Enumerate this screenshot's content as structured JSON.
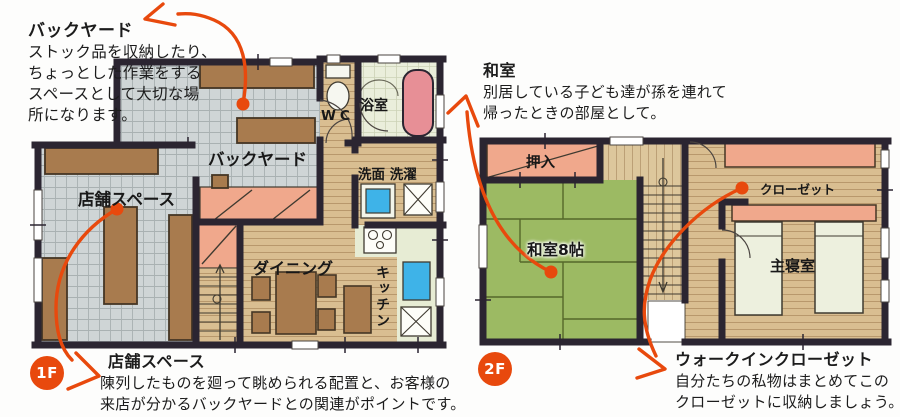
{
  "colors": {
    "accent": "#e8490d",
    "wall": "#2b2531",
    "floor_grid": "#cfd5d6",
    "wood": "#d9be91",
    "tatami_green": "#9cba63",
    "salmon": "#f0a88c",
    "furniture_brown": "#a87b4e",
    "bath_green": "#eaeedb",
    "tub_pink": "#e78f96",
    "water_blue": "#3eb3e8"
  },
  "floor1": {
    "badge": "1F",
    "note_backyard": {
      "title": "バックヤード",
      "lines": [
        "ストック品を収納したり、",
        "ちょっとした作業をする",
        "スペースとして大切な場",
        "所になります。"
      ]
    },
    "note_shop": {
      "title": "店舗スペース",
      "lines": [
        "陳列したものを廻って眺められる配置と、お客様の",
        "来店が分かるバックヤードとの関連がポイントです。"
      ]
    },
    "labels": {
      "backyard": "バックヤード",
      "shop": "店舗スペース",
      "bath": "浴室",
      "wc": "WC",
      "laundry": "洗面 洗濯",
      "dining": "ダイニング",
      "kitchen": "キッチン"
    }
  },
  "floor2": {
    "badge": "2F",
    "note_washitsu": {
      "title": "和室",
      "lines": [
        "別居している子ども達が孫を連れて",
        "帰ったときの部屋として。"
      ]
    },
    "note_wic": {
      "title": "ウォークインクローゼット",
      "lines": [
        "自分たちの私物はまとめてこの",
        "クローゼットに収納しましょう。"
      ]
    },
    "labels": {
      "oshiire": "押入",
      "washitsu": "和室8帖",
      "closet": "クローゼット",
      "bedroom": "主寝室"
    }
  }
}
